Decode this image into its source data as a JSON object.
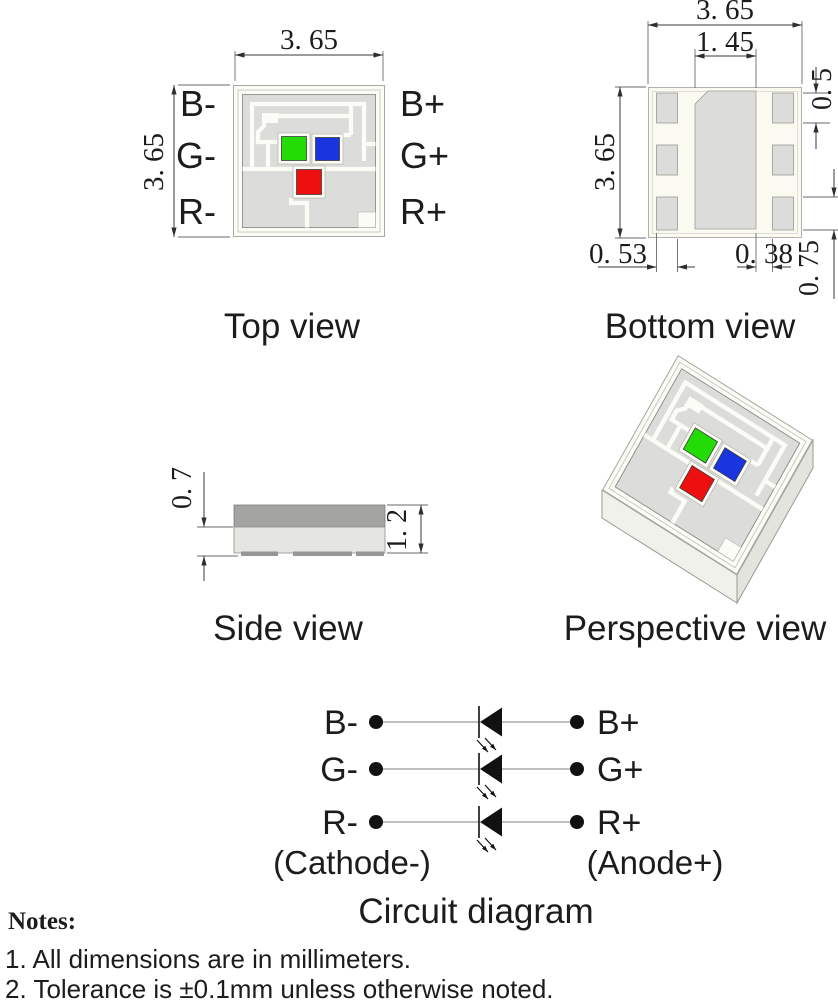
{
  "colors": {
    "die_green": "#24DC05",
    "die_blue": "#1A35DF",
    "die_red": "#EE1010",
    "pad_gray": "#dcdcda",
    "body_cream": "#fafaf0",
    "side_dark_top": "#a4a4a3",
    "side_light_base": "#e5e5e2"
  },
  "top_view": {
    "title": "Top view",
    "dim_width": "3. 65",
    "dim_height": "3. 65",
    "pins_left": [
      "B-",
      "G-",
      "R-"
    ],
    "pins_right": [
      "B+",
      "G+",
      "R+"
    ]
  },
  "bottom_view": {
    "title": "Bottom view",
    "dim_width": "3. 65",
    "dim_height": "3. 65",
    "dim_center_pad_width": "1. 45",
    "dim_side_pad_height": "0. 5",
    "dim_side_pad_width": "0. 53",
    "dim_pad_gap": "0. 38",
    "dim_corner_pad_height": "0. 75"
  },
  "side_view": {
    "title": "Side view",
    "dim_base_height": "0. 7",
    "dim_total_height": "1. 2"
  },
  "perspective_view": {
    "title": "Perspective view"
  },
  "circuit": {
    "title": "Circuit diagram",
    "rows": [
      {
        "neg": "B-",
        "pos": "B+"
      },
      {
        "neg": "G-",
        "pos": "G+"
      },
      {
        "neg": "R-",
        "pos": "R+"
      }
    ],
    "cathode_label": "(Cathode-)",
    "anode_label": "(Anode+)"
  },
  "notes": {
    "heading": "Notes:",
    "items": [
      "1. All dimensions are in millimeters.",
      "2. Tolerance is  ±0.1mm unless otherwise noted."
    ]
  }
}
